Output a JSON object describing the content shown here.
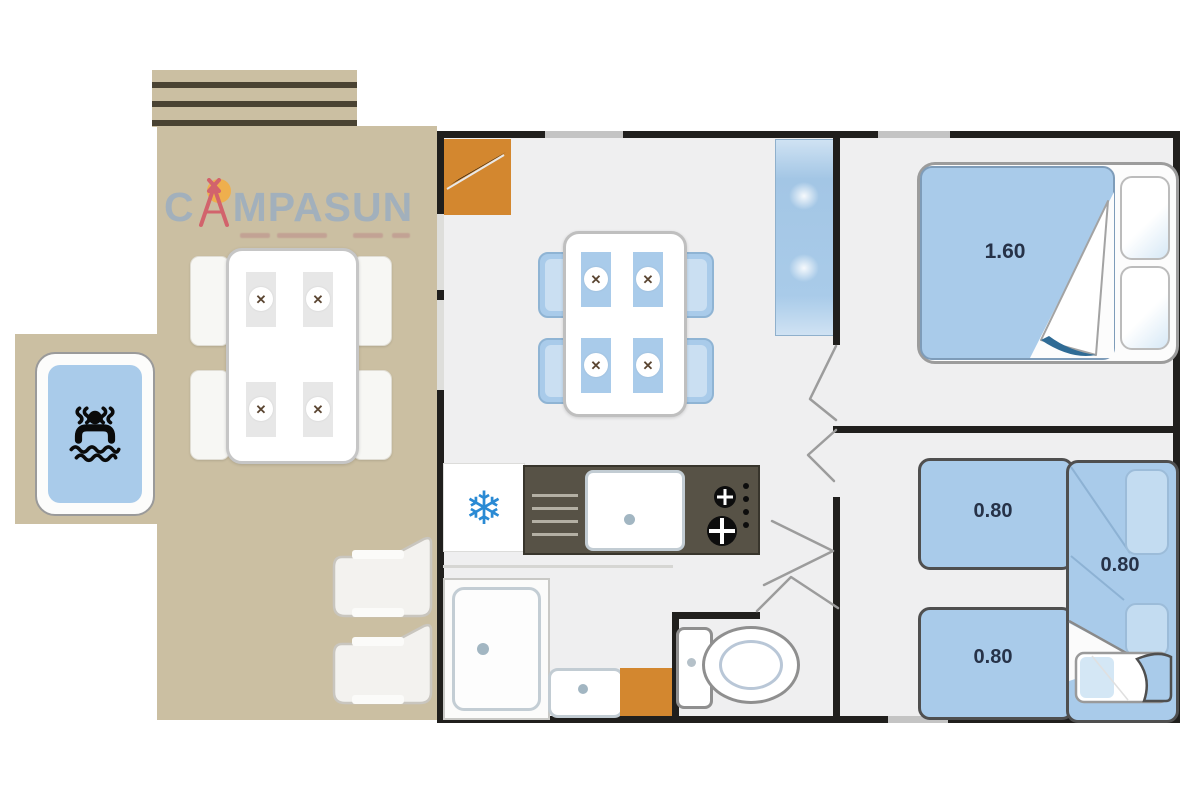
{
  "logo": {
    "prefix": "C",
    "suffix": "MPASUN",
    "full_name": "CAMPASUN"
  },
  "glyphs": {
    "cutlery": "✕",
    "snowflake": "❄"
  },
  "labels": {
    "double_bed_width": "1.60",
    "single_bed_a_width": "0.80",
    "single_bed_b_width": "0.80",
    "single_bed_c_width": "0.80"
  },
  "icons": {
    "jacuzzi": "person-in-hot-tub",
    "snowflake": "fridge-freezer",
    "cutlery": "crossed-fork-knife",
    "door_blade": "open-door-leaf"
  },
  "colors": {
    "terrace": "#cbbfa2",
    "slat-line": "#4a4332",
    "floor": "#efeff0",
    "wall": "#201f1d",
    "window": "#c4c4c4",
    "blue": "#a9cbea",
    "blue-border": "#7e9cb9",
    "pillow-blue": "#c3dcf1",
    "door-orange": "#d3872f",
    "counter": "#575246",
    "snowflake": "#2a8ad4",
    "logo-text": "#a2b0bc",
    "logo-tent": "#d2636c",
    "logo-sun": "#efae49",
    "label-navy": "#263248"
  }
}
